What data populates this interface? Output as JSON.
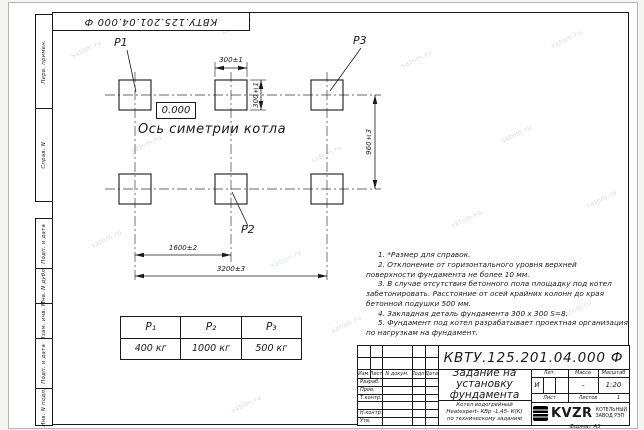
{
  "watermark": "satom.ru",
  "stamp": {
    "designation": "КВТУ.125.201.04.000    Ф"
  },
  "margin_labels": {
    "perv": "Перв. примен.",
    "sprav": "Справ. N",
    "podp1": "Подп. и дата",
    "inv_dubl": "Инв. N дубл.",
    "vzam": "Взам. инв. N",
    "podp2": "Подп. и дата",
    "inv_podl": "Инв. N подл."
  },
  "drawing": {
    "pad_labels": {
      "p1": "P1",
      "p2": "P2",
      "p3": "P3"
    },
    "level_mark": "0.000",
    "axis_label": "Ось симетрии котла",
    "dimensions": {
      "pad_width": "300±1",
      "pad_height": "300±1",
      "row_spacing": "960±3",
      "col_spacing": "1600±2",
      "total_width": "3200±3"
    }
  },
  "load_table": {
    "headers": [
      "P₁",
      "P₂",
      "P₃"
    ],
    "values": [
      "400 кг",
      "1000 кг",
      "500 кг"
    ]
  },
  "notes": [
    "1. *Размер для справок.",
    "2. Отклонение от горизонтального уровня верхней поверхности фундамента не более 10 мм.",
    "3. В случае отсутствия бетонного пола площадку под котел забетонировать. Расстояние от осей крайних колонн до края бетонной подушки 500 мм.",
    "4. Закладная деталь фундамента  300 х 300  S=8.",
    "5. Фундамент под котел разрабатывает проектная организация по нагрузкам на фундамент."
  ],
  "title_block": {
    "designation": "КВТУ.125.201.04.000  Ф",
    "rev_columns": [
      "Изм.",
      "Лист",
      "N докум.",
      "Подп.",
      "Дата"
    ],
    "sign_rows": [
      "Разраб.",
      "Пров.",
      "Т.контр.",
      "",
      "Н.контр.",
      "Утв."
    ],
    "doc_title_lines": [
      "Задание на",
      "установку",
      "фундамента"
    ],
    "product_lines": [
      "Котел водогрейный",
      "Heatexpert- КВр -1,45- К(К)",
      "по техническому заданию"
    ],
    "lit_label": "Лит.",
    "lit_value": "И",
    "mass_label": "Масса",
    "mass_value": "–",
    "scale_label": "Масштаб",
    "scale_value": "1:20",
    "sheet_label": "Лист",
    "sheets_label": "Листов",
    "sheets_value": "1",
    "company": {
      "logo_text": "KVZR",
      "line1": "КОТЕЛЬНЫЙ",
      "line2": "ЗАВОД РЭП"
    },
    "format_note": "Формат А3"
  }
}
